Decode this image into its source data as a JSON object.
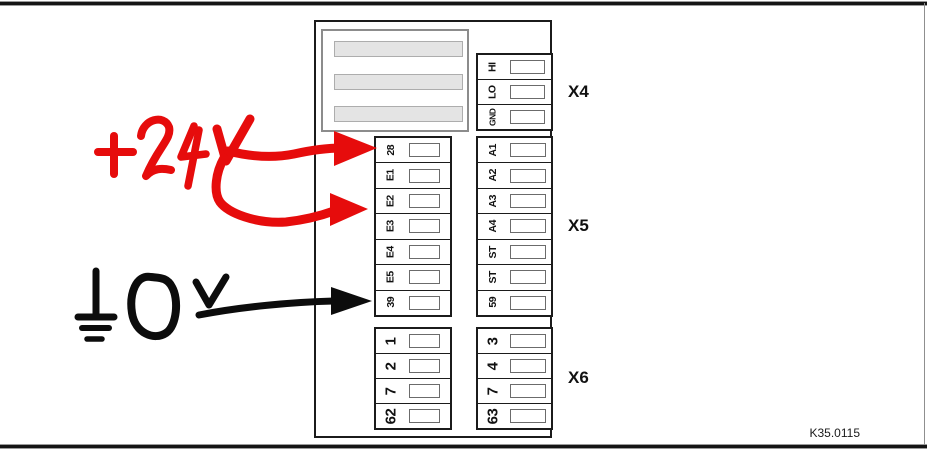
{
  "figure": {
    "ref_label": "K35.0115"
  },
  "display_module": {
    "bars": 3
  },
  "blocks": {
    "x4": {
      "label": "X4",
      "rows": [
        "HI",
        "LO",
        "GND"
      ]
    },
    "x5": {
      "label": "X5",
      "left_rows": [
        "28",
        "E1",
        "E2",
        "E3",
        "E4",
        "E5",
        "39"
      ],
      "right_rows": [
        "A1",
        "A2",
        "A3",
        "A4",
        "ST",
        "ST",
        "59"
      ]
    },
    "x6": {
      "label": "X6",
      "left_rows": [
        "1",
        "2",
        "7",
        "62"
      ],
      "right_rows": [
        "3",
        "4",
        "7",
        "63"
      ]
    }
  },
  "annotations": {
    "red": {
      "text": "+24V",
      "color": "#e60c0c",
      "targets": [
        "28",
        "E2"
      ]
    },
    "black": {
      "text": "0V",
      "symbol": "ground",
      "color": "#0c0c0c",
      "targets": [
        "39"
      ]
    }
  }
}
